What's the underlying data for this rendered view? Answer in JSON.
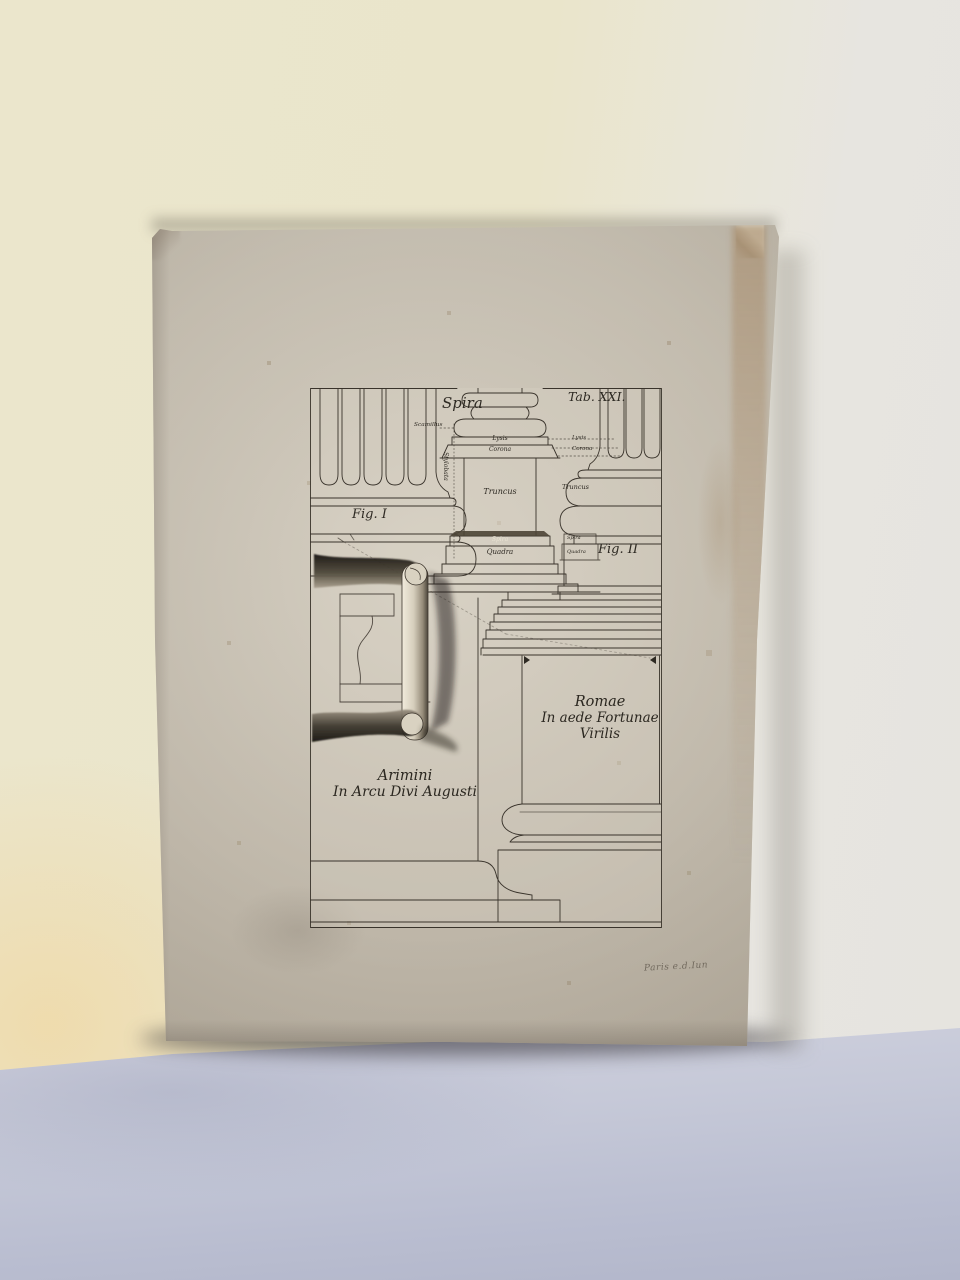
{
  "plate": {
    "tab_label": "Tab. XXI.",
    "spira_title": "Spira",
    "fig1_label": "Fig. I",
    "fig2_label": "Fig. II",
    "part_labels": {
      "scamillus": "Scamillus",
      "lysis_center": "Lysis",
      "corona_center": "Corona",
      "lysis_right": "Lysis",
      "corona_right": "Corona",
      "stylobata": "Stylobata",
      "truncus_center": "Truncus",
      "truncus_right": "Truncus",
      "spira_center": "Spira",
      "quadra_center": "Quadra",
      "spira_right": "Spira",
      "quadra_right": "Quadra"
    },
    "captions": {
      "arimini_line1": "Arimini",
      "arimini_line2": "In Arcu Divi Augusti",
      "romae_line1": "Romae",
      "romae_line2": "In aede Fortunae",
      "romae_line3": "Virilis"
    }
  },
  "annotations": {
    "pencil_note": "Paris e.d.Iun"
  },
  "colors": {
    "wall_left": "#eae5cb",
    "wall_right": "#e6e4df",
    "wall_glow": "#f2d394",
    "cloth": "#c6c9d8",
    "paper": "#c0b9ab",
    "paper_highlight": "#d8d2c5",
    "paper_edge_tint": "#9e784e",
    "ink": "#39332b",
    "pencil": "#71695d"
  }
}
